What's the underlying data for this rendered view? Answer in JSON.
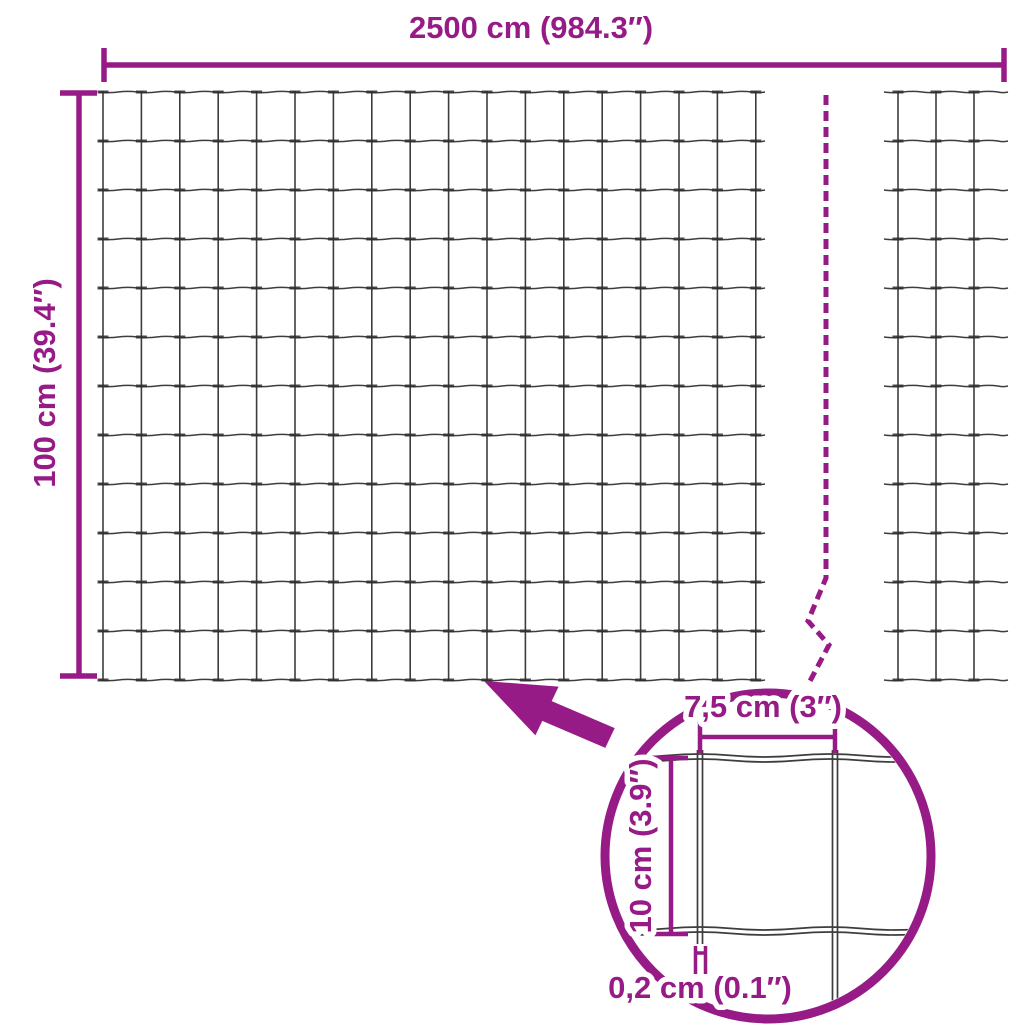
{
  "colors": {
    "accent": "#971B87",
    "wire": "#3D3D3D",
    "weld": "#2E2E2E",
    "background": "#FFFFFF"
  },
  "dimensions": {
    "total_width_label": "2500 cm (984.3″)",
    "total_height_label": "100 cm (39.4″)",
    "mesh_cell_width_label": "7,5 cm (3″)",
    "mesh_cell_height_label": "10 cm (3.9″)",
    "wire_thickness_label": "0,2 cm (0.1″)"
  }
}
